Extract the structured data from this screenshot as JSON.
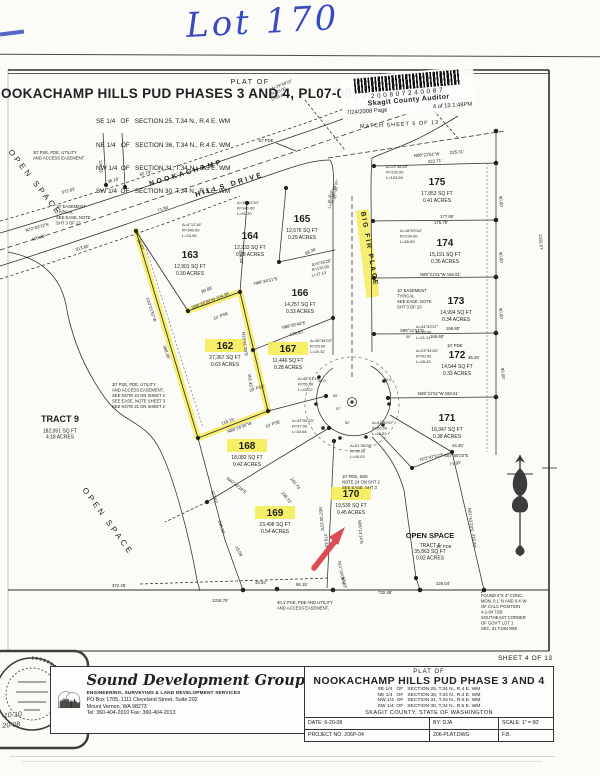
{
  "annotation": {
    "handwritten": "Lot 170"
  },
  "stamp": {
    "barcode_number": "200807240087",
    "auditor": "Skagit County Auditor",
    "date": "7/24/2008 Page",
    "pages": "4 of  13 1:48PM"
  },
  "header": {
    "plat_of": "PLAT OF",
    "title": "NOOKACHAMP HILLS PUD PHASES 3 AND 4, PL07-0870",
    "sections": [
      "SE 1/4   OF   SECTION 25, T.34 N., R.4 E. WM",
      "NE 1/4   OF   SECTION 36, T.34 N., R.4 E. WM",
      "NW 1/4  OF   SECTION 31, T.34 N., R.5 E. WM",
      "SW 1/4  OF   SECTION 30, T.34 N., R.5 E. WM"
    ]
  },
  "sheet_note": "SHEET 4 OF 13",
  "map": {
    "lots": [
      [
        "162",
        "27,367 SQ FT",
        "0.63 ACRES",
        225,
        349,
        1
      ],
      [
        "163",
        "12,901 SQ FT",
        "0.30 ACRES",
        190,
        258,
        0
      ],
      [
        "164",
        "12,233 SQ FT",
        "0.28 ACRES",
        250,
        239,
        0
      ],
      [
        "165",
        "12,676 SQ FT",
        "0.29 ACRES",
        302,
        222,
        0
      ],
      [
        "166",
        "14,257 SQ FT",
        "0.33 ACRES",
        300,
        296,
        0
      ],
      [
        "167",
        "11,446 SQ FT",
        "0.28 ACRES",
        288,
        352,
        1
      ],
      [
        "168",
        "18,082 SQ FT",
        "0.42 ACRES",
        247,
        449,
        1
      ],
      [
        "169",
        "23,498 SQ FT",
        "0.54 ACRES",
        275,
        516,
        1
      ],
      [
        "170",
        "19,539 SQ FT",
        "0.45 ACRES",
        351,
        497,
        1
      ],
      [
        "171",
        "16,347 SQ FT",
        "0.38 ACRES",
        447,
        421,
        0
      ],
      [
        "172",
        "14,544 SQ FT",
        "0.33 ACRES",
        457,
        358,
        0
      ],
      [
        "173",
        "14,994 SQ FT",
        "0.34 ACRES",
        456,
        304,
        0
      ],
      [
        "174",
        "15,191 SQ FT",
        "0.35 ACRES",
        445,
        246,
        0
      ],
      [
        "175",
        "17,853 SQ FT",
        "0.41 ACRES",
        437,
        185,
        0
      ]
    ],
    "dims": [
      [
        "36.18'",
        108,
        183,
        -15
      ],
      [
        "62.79'",
        140,
        176,
        -15
      ],
      [
        "372.83'",
        62,
        194,
        -16
      ],
      [
        "N72°03'12\"E",
        26,
        232,
        -16
      ],
      [
        "420.98'",
        32,
        241,
        -16
      ],
      [
        "313.80'",
        76,
        251,
        -16
      ],
      [
        "134.31'",
        99,
        160,
        87
      ],
      [
        "30.02'",
        137,
        240,
        64
      ],
      [
        "71.36'",
        158,
        212,
        -18
      ],
      [
        "90.85'",
        202,
        293,
        -21
      ],
      [
        "S88°26'30\"W 104.26'",
        192,
        309,
        -21
      ],
      [
        "10' PSE",
        214,
        320,
        -21
      ],
      [
        "S10°21'52\"W",
        146,
        298,
        72
      ],
      [
        "388.95'",
        163,
        346,
        72
      ],
      [
        "N13°41'39\"E",
        242,
        332,
        83
      ],
      [
        "161.45'",
        248,
        374,
        83
      ],
      [
        "134.48'",
        239,
        250,
        85
      ],
      [
        "20' PSE",
        250,
        392,
        -18
      ],
      [
        "118.15'",
        222,
        425,
        -20
      ],
      [
        "N88°26'30\"W",
        228,
        433,
        -20
      ],
      [
        "10' PSE",
        266,
        428,
        -20
      ],
      [
        "10' PDE",
        258,
        142,
        0
      ],
      [
        "88.36'",
        306,
        255,
        -25
      ],
      [
        "N88°34'51\"E",
        254,
        285,
        -12
      ],
      [
        "N88°35'40\"E",
        282,
        329,
        -12
      ],
      [
        "139.00'",
        290,
        336,
        -12
      ],
      [
        "MATCH SHEET 5 OF 13",
        360,
        128,
        -3,
        5.5,
        1
      ],
      [
        "N88°21'51\"W",
        414,
        157,
        -4
      ],
      [
        "225.31'",
        450,
        154,
        -4
      ],
      [
        "222.71'",
        428,
        163,
        -4
      ],
      [
        "177.85'",
        440,
        218,
        0
      ],
      [
        "175.78'",
        434,
        224,
        0
      ],
      [
        "N88°21'51\"W  166.61'",
        420,
        276,
        0
      ],
      [
        "S88°21'51\"E",
        400,
        332,
        0
      ],
      [
        "159.80'",
        446,
        330,
        0
      ],
      [
        "165.60'",
        430,
        338,
        0
      ],
      [
        "10' PDE",
        447,
        347,
        0
      ],
      [
        "N88°21'51\"W  160.61'",
        418,
        395,
        0
      ],
      [
        "90.00'",
        499,
        196,
        85
      ],
      [
        "90.00'",
        499,
        252,
        85
      ],
      [
        "90.00'",
        499,
        308,
        85
      ],
      [
        "90.00'",
        501,
        368,
        85
      ],
      [
        "1333.67'",
        539,
        234,
        87
      ],
      [
        "35.26'",
        468,
        359,
        0
      ],
      [
        "44.45'",
        452,
        447,
        0
      ],
      [
        "N87°50'23\"E",
        444,
        457,
        0
      ],
      [
        "N72°47'51\"E",
        420,
        461,
        -12
      ],
      [
        "71.83'",
        450,
        466,
        -12
      ],
      [
        "N01°43'23\"E",
        468,
        508,
        84
      ],
      [
        "210.84'",
        472,
        534,
        84
      ],
      [
        "N40°40'26\"E",
        226,
        479,
        38
      ],
      [
        "243.73'",
        290,
        479,
        52
      ],
      [
        "236.72'",
        281,
        493,
        52
      ],
      [
        "117.62'",
        211,
        491,
        72
      ],
      [
        "138.26'",
        218,
        521,
        72
      ],
      [
        "18.09'",
        235,
        547,
        62
      ],
      [
        "N02°36'13\"E",
        319,
        507,
        85
      ],
      [
        "278.43'",
        324,
        534,
        85
      ],
      [
        "N06°14'14\"E",
        358,
        520,
        85
      ],
      [
        "N11°18'09\"E",
        338,
        561,
        80
      ],
      [
        "53.83'",
        342,
        577,
        80
      ],
      [
        "45.83'",
        255,
        584,
        0
      ],
      [
        "86.15'",
        296,
        586,
        0
      ],
      [
        "372.45'",
        112,
        587,
        0
      ],
      [
        "1318.76'",
        212,
        602,
        0
      ],
      [
        "732.48'",
        378,
        594,
        0
      ],
      [
        "226.04'",
        436,
        585,
        0
      ],
      [
        "10' PDE",
        436,
        548,
        0
      ],
      [
        "40.0'",
        318,
        382,
        0,
        3.8
      ],
      [
        "40.0'",
        384,
        381,
        0,
        3.8
      ],
      [
        "55'",
        333,
        397,
        0,
        3.6
      ],
      [
        "57'",
        336,
        410,
        0,
        3.6
      ],
      [
        "52'",
        345,
        424,
        0,
        3.6
      ],
      [
        "30'",
        406,
        338,
        0,
        3.6
      ],
      [
        "BIG  FIR  PLACE",
        361,
        212,
        80,
        6.8,
        2,
        1
      ],
      [
        "NOOKACHAMP",
        150,
        186,
        -17,
        7,
        2.5,
        1
      ],
      [
        "HILLS   DRIVE",
        196,
        197,
        -17,
        7,
        2.5,
        1
      ],
      [
        "OPEN  SPACE",
        8,
        152,
        52,
        8,
        3,
        0
      ],
      [
        "OPEN  SPACE",
        82,
        490,
        54,
        8,
        3,
        0
      ]
    ],
    "curves": [
      {
        "l": [
          "Δ=79°58'10\"",
          "R=25.00",
          "L=34.89"
        ],
        "x": 272,
        "y": 90,
        "r": -22
      },
      {
        "l": [
          "Δ=4°12'16\"",
          "R=340.00",
          "L=24.95"
        ],
        "x": 182,
        "y": 226,
        "r": 0
      },
      {
        "l": [
          "Δ=15°22'20\"",
          "R=340.00",
          "L=91.20"
        ],
        "x": 237,
        "y": 204,
        "r": 0
      },
      {
        "l": [
          "Δ=5°44'47\"",
          "R=342.00",
          "L=34.30"
        ],
        "x": 330,
        "y": 198,
        "r": -62
      },
      {
        "l": [
          "Δ=23°36'28\"",
          "R=232.00",
          "L=103.69"
        ],
        "x": 386,
        "y": 168,
        "r": 0
      },
      {
        "l": [
          "Δ=18°03'34\"",
          "R=234.00",
          "L=65.59"
        ],
        "x": 400,
        "y": 232,
        "r": 0
      },
      {
        "l": [
          "Δ=5°46'28\"",
          "R=170.00",
          "L=17.13"
        ],
        "x": 312,
        "y": 266,
        "r": -12
      },
      {
        "l": [
          "Δ=45°34'03\"",
          "R=25.00",
          "L=20.32"
        ],
        "x": 310,
        "y": 342,
        "r": 0
      },
      {
        "l": [
          "Δ=45°01'19\"",
          "R=55.00",
          "L=43.22"
        ],
        "x": 298,
        "y": 380,
        "r": 0
      },
      {
        "l": [
          "Δ=43°54'33\"",
          "R=57.00",
          "L=43.68"
        ],
        "x": 292,
        "y": 422,
        "r": 0
      },
      {
        "l": [
          "Δ=51°36'08\"",
          "R=50.00",
          "L=45.03"
        ],
        "x": 350,
        "y": 447,
        "r": 0
      },
      {
        "l": [
          "Δ=41°50'57\"",
          "R=50.00",
          "L=36.52"
        ],
        "x": 372,
        "y": 424,
        "r": 0
      },
      {
        "l": [
          "Δ=34°33'37\"",
          "R=35.00",
          "L=21.11"
        ],
        "x": 416,
        "y": 328,
        "r": 0
      },
      {
        "l": [
          "Δ=23°34'26\"",
          "R=50.00",
          "L=28.43"
        ],
        "x": 416,
        "y": 352,
        "r": 0
      }
    ],
    "notes": [
      {
        "l": [
          "30' PSE, PDE, UTILITY",
          "AND ACCESS EASEMENT"
        ],
        "x": 33,
        "y": 154
      },
      {
        "l": [
          "10' EASEMENT",
          "TYPICAL",
          "SEE EASE. NOTE",
          "SHT 3 OF 13"
        ],
        "x": 56,
        "y": 208
      },
      {
        "l": [
          "30' PSE, PDE, UTILITY",
          "AND ACCESS EASEMENT,",
          "SEE NOTE 24 ON SHEET 2",
          "SEE EASE. NOTE SHEET 3",
          "SEE NOTE 21 ON SHEET 2"
        ],
        "x": 112,
        "y": 386
      },
      {
        "l": [
          "10' PDE, SEE",
          "NOTE 24 ON SHT 2",
          "SEE EASE. SHT 3"
        ],
        "x": 342,
        "y": 478
      },
      {
        "l": [
          "10' EASEMENT",
          "TYPICAL",
          "SEE EASE. NOTE",
          "SHT 3 OF 13"
        ],
        "x": 397,
        "y": 292
      },
      {
        "l": [
          "40.1' PSE, PDE AND  UTILITY",
          "AND ACCESS EASEMENT,"
        ],
        "x": 277,
        "y": 604
      },
      {
        "l": [
          "FOUND 4\"X 4\" CONC.",
          "MON. 0.1' N AND 0.4' W",
          "OF CALC POSITION",
          "4-1-04   72/9",
          "SOUTHEAST CORNER",
          "OF GOV'T LOT 1",
          "SEC. 31 T34N R5E"
        ],
        "x": 481,
        "y": 597
      },
      {
        "l": [
          "TRACT 9",
          "182,051 SQ FT",
          "4.18 ACRES"
        ],
        "x": 60,
        "y": 422,
        "fs": 9,
        "s": 5,
        "c": 1
      },
      {
        "l": [
          "OPEN  SPACE",
          "TRACT 6",
          "35,863 SQ FT",
          "0.82 ACRES"
        ],
        "x": 430,
        "y": 538,
        "fs": 7.5,
        "s": 5,
        "c": 1
      }
    ]
  },
  "title_block": {
    "firm": {
      "name": "Sound Development Group",
      "tagline": "ENGINEERING, SURVEYING & LAND DEVELOPMENT SERVICES",
      "addr": "PO Box 1705, 1111 Cleveland Street, Suite 202\nMount Vernon, WA 98273\nTel:  360-404-2010    Fax:  360-404-2013"
    },
    "plat_of": "PLAT OF",
    "title": "NOOKACHAMP HILLS PUD PHASE 3 AND 4",
    "sections": "SE 1/4   OF   SECTION 25, T.34 N., R.4 E. WM\nNE 1/4   OF   SECTION 36, T.34 N., R.4 E. WM\nNW 1/4  OF   SECTION 31, T.34 N., R.5 E. WM\nSW 1/4  OF   SECTION 30, T.34 N., R.5 E. WM",
    "county": "SKAGIT COUNTY, STATE OF WASHINGTON",
    "date": "DATE:   6-20-08",
    "by": "BY: DJA",
    "scale": "SCALE:    1\" = 60'",
    "project": "PROJECT NO.   206P-04",
    "dwg": "206-PLAT.DWG",
    "fb": "F.B.",
    "seal_dates": [
      "-10-10",
      "20-08"
    ]
  },
  "colors": {
    "highlight": "#f4eb4d",
    "ink": "#2b2b2b",
    "blue_pen": "#3a49c3",
    "red_arrow": "#de4b52"
  }
}
